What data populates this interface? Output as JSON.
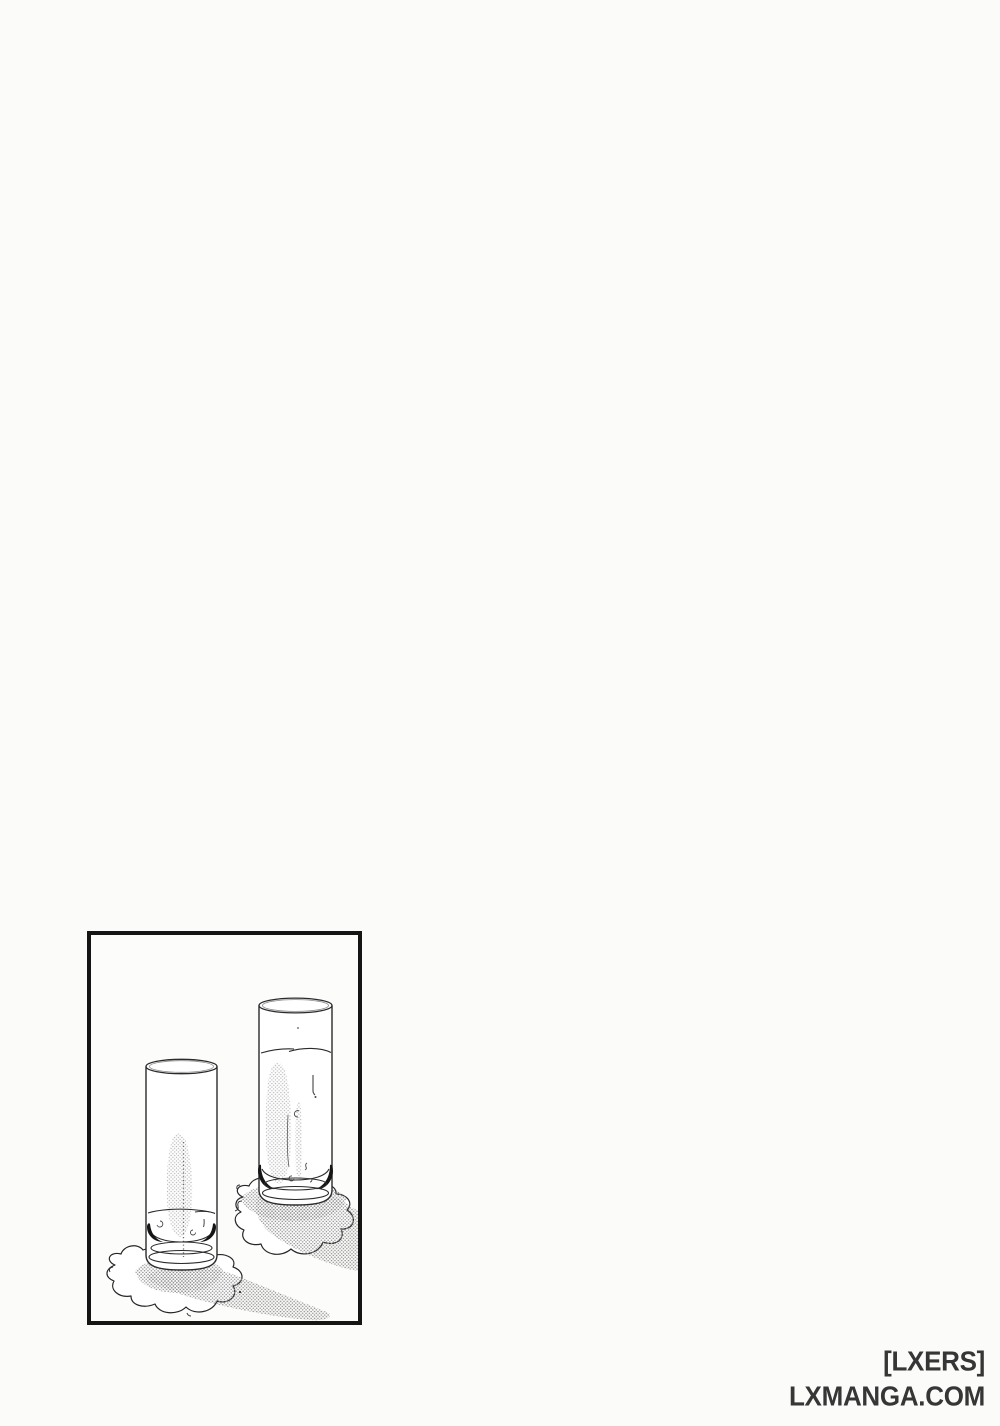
{
  "page": {
    "background_color": "#fbfbfa"
  },
  "panel": {
    "name": "manga-panel",
    "border_color": "#151515",
    "illustration": "two-glasses-of-water-with-spilled-puddles",
    "tone_color": "#8f8f8f",
    "line_color": "#2b2b2b"
  },
  "watermark": {
    "lines": [
      "[LXERS]",
      "LXMANGA.COM"
    ],
    "color": "#363636"
  }
}
